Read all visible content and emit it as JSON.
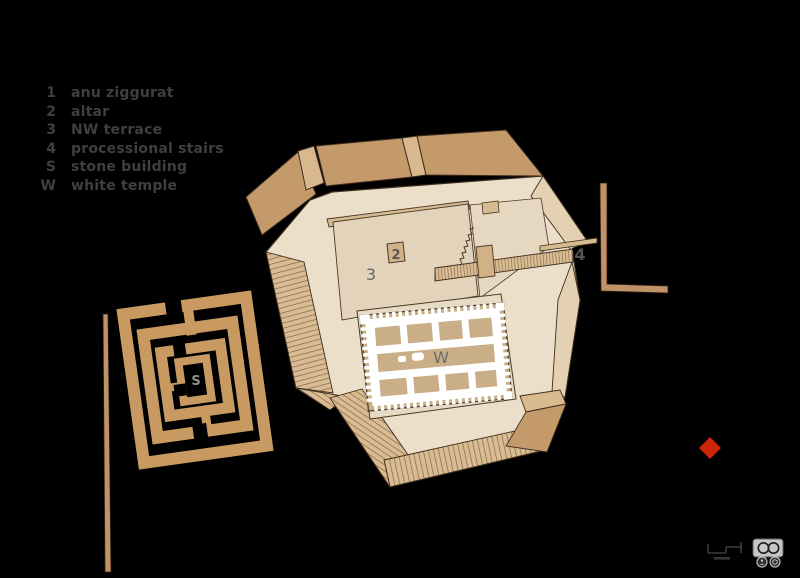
{
  "legend": {
    "items": [
      {
        "key": "1",
        "label": "anu ziggurat"
      },
      {
        "key": "2",
        "label": "altar"
      },
      {
        "key": "3",
        "label": "NW terrace"
      },
      {
        "key": "4",
        "label": "processional stairs"
      },
      {
        "key": "S",
        "label": "stone building"
      },
      {
        "key": "W",
        "label": "white temple"
      }
    ]
  },
  "plan": {
    "labels": {
      "altar": "2",
      "nw_terrace": "3",
      "processional_stairs": "4",
      "stone_building": "S",
      "white_temple": "W"
    }
  },
  "marker": {
    "color": "#cc2607"
  },
  "icons": {
    "scale_bar": "scale-bar",
    "license_badge": "cc-by-sa-badge"
  },
  "colors": {
    "background": "#000000",
    "platform_top": "#ebdfca",
    "terrace": "#e3d3bb",
    "rim_dark": "#c49a6b",
    "hatch_base": "#d9bc93",
    "hatch_line": "#7e6042",
    "stone_building": "#c89a61",
    "temple_floor": "#c9ae87",
    "temple_wall": "#ffffff",
    "outline": "#3e2d1d",
    "label_gray": "#5f6062",
    "legend_gray": "#3f3f3f"
  }
}
